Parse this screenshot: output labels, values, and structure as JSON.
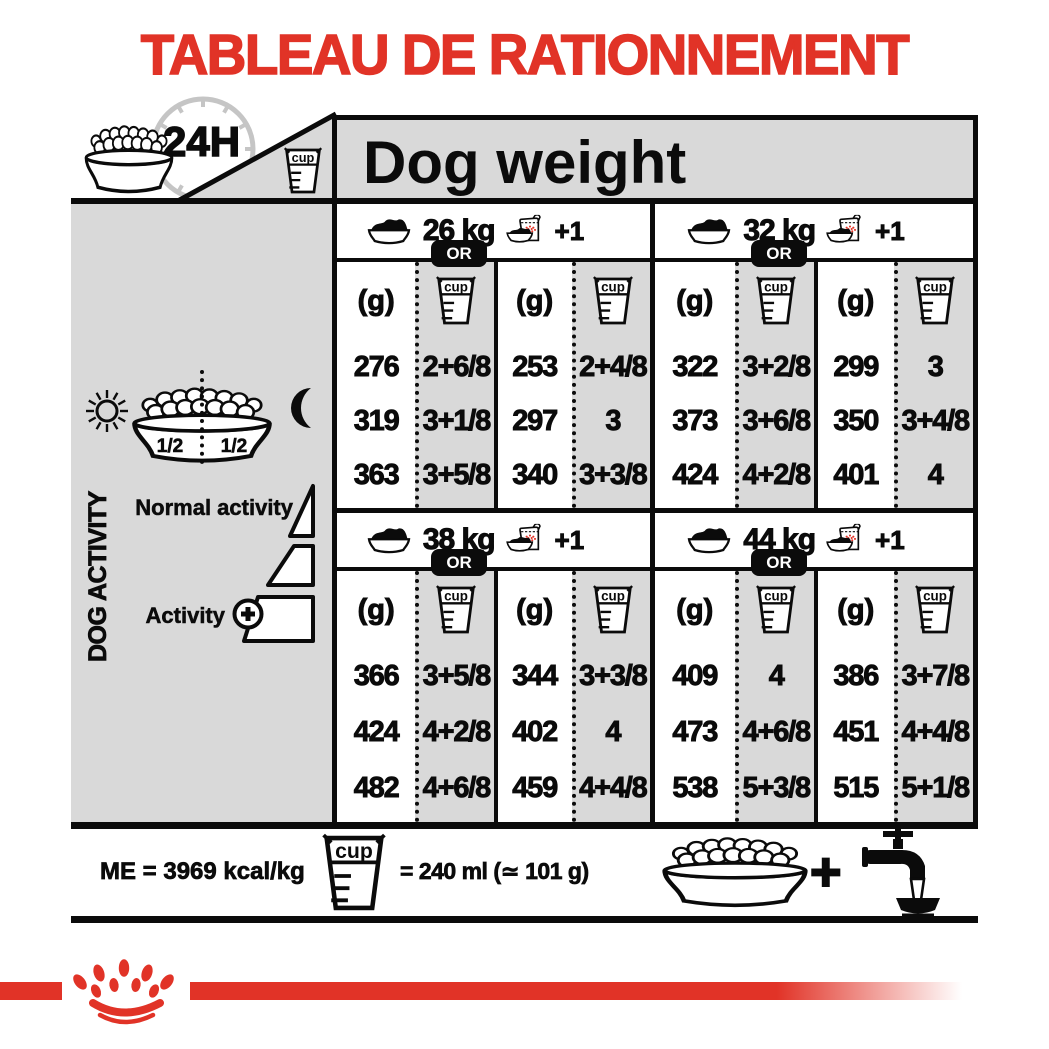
{
  "title": "TABLEAU DE RATIONNEMENT",
  "header": {
    "time_label": "24H",
    "dog_weight_label": "Dog weight"
  },
  "icons": {
    "cup_label": "cup",
    "names": [
      "kibble-bowl-icon",
      "24h-clock-icon",
      "measuring-cup-icon",
      "food-bowl-icon",
      "food-bag-plus-one-icon",
      "sun-icon",
      "moon-icon",
      "activity-triangle-icons",
      "plus-circle-icon",
      "water-tap-icon",
      "royal-canin-crown-logo"
    ]
  },
  "sidebar": {
    "panel_title": "DOG ACTIVITY",
    "morning_half": "1/2",
    "evening_half": "1/2",
    "normal_activity_label": "Normal activity",
    "activity_label": "Activity",
    "activity_plus": "+"
  },
  "table": {
    "or_label": "OR",
    "plus_one_label": "+1",
    "grams_header": "(g)"
  },
  "chart_data": {
    "type": "table",
    "title": "TABLEAU DE RATIONNEMENT",
    "subtitle": "Dog weight",
    "units": [
      "g",
      "cup"
    ],
    "activity_rows": [
      "Normal activity",
      "intermediate",
      "Activity +"
    ],
    "sections": [
      {
        "weight": "26 kg",
        "rows": [
          [
            "276",
            "2+6/8",
            "253",
            "2+4/8"
          ],
          [
            "319",
            "3+1/8",
            "297",
            "3"
          ],
          [
            "363",
            "3+5/8",
            "340",
            "3+3/8"
          ]
        ]
      },
      {
        "weight": "32 kg",
        "rows": [
          [
            "322",
            "3+2/8",
            "299",
            "3"
          ],
          [
            "373",
            "3+6/8",
            "350",
            "3+4/8"
          ],
          [
            "424",
            "4+2/8",
            "401",
            "4"
          ]
        ]
      },
      {
        "weight": "38 kg",
        "rows": [
          [
            "366",
            "3+5/8",
            "344",
            "3+3/8"
          ],
          [
            "424",
            "4+2/8",
            "402",
            "4"
          ],
          [
            "482",
            "4+6/8",
            "459",
            "4+4/8"
          ]
        ]
      },
      {
        "weight": "44 kg",
        "rows": [
          [
            "409",
            "4",
            "386",
            "3+7/8"
          ],
          [
            "473",
            "4+6/8",
            "451",
            "4+4/8"
          ],
          [
            "538",
            "5+3/8",
            "515",
            "5+1/8"
          ]
        ]
      }
    ]
  },
  "footer": {
    "energy": "ME = 3969 kcal/kg",
    "cup_equivalence": "= 240 ml (≃ 101 g)",
    "plus_sign": "+"
  },
  "colors": {
    "brand_red": "#e13327",
    "panel_gray": "#d9d9d9",
    "clock_gray": "#c5c5c5"
  }
}
